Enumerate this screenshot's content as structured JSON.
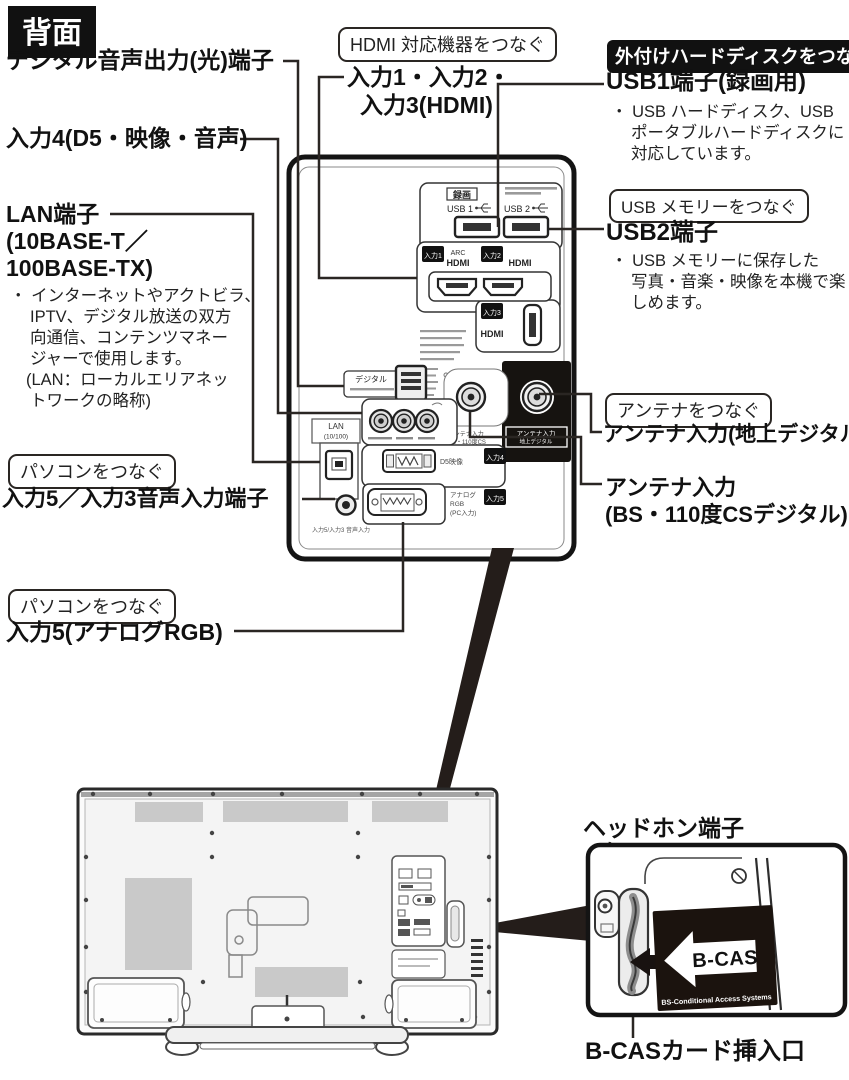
{
  "header": {
    "badge": "背面"
  },
  "left_column": {
    "digital_audio_label": "デジタル音声出力(光)端子",
    "input4_label": "入力4(D5・映像・音声)",
    "lan_label_lines": [
      "LAN端子",
      "(10BASE-T／",
      "100BASE-TX)"
    ],
    "lan_note_lines": [
      "・ インターネットやアクトビラ、",
      "IPTV、デジタル放送の双方",
      "向通信、コンテンツマネー",
      "ジャーで使用します。",
      "(LAN：ローカルエリアネッ",
      "トワークの略称)"
    ],
    "pc_connect_box_1": "パソコンをつなぐ",
    "input5_audio_label": "入力5／入力3音声入力端子",
    "pc_connect_box_2": "パソコンをつなぐ",
    "input5_rgb_label": "入力5(アナログRGB)"
  },
  "top_center": {
    "hdmi_connect_box": "HDMI 対応機器をつなぐ",
    "hdmi_inputs_lines": [
      "入力1・入力2・",
      "入力3(HDMI)"
    ]
  },
  "right_column": {
    "hdd_connect_badge": "外付けハードディスクをつなぐ",
    "usb1_label": "USB1端子(録画用)",
    "usb1_note_lines": [
      "・ USB ハードディスク、USB",
      "ポータブルハードディスクに",
      "対応しています。"
    ],
    "usb_memory_box": "USB メモリーをつなぐ",
    "usb2_label": "USB2端子",
    "usb2_note_lines": [
      "・ USB メモリーに保存した",
      "写真・音楽・映像を本機で楽",
      "しめます。"
    ],
    "antenna_connect_box": "アンテナをつなぐ",
    "antenna_terrestrial_label": "アンテナ入力(地上デジタル)",
    "antenna_bs_lines": [
      "アンテナ入力",
      "(BS・110度CSデジタル)"
    ]
  },
  "rear_panel": {
    "rec_badge": "録画",
    "usb1": "USB 1",
    "usb2": "USB 2",
    "input1_badge": "入力1",
    "input2_badge": "入力2",
    "input3_badge": "入力3",
    "input4_badge": "入力4",
    "input5_badge": "入力5",
    "arc": "ARC",
    "hdmi_logo_1": "HDMI",
    "hdmi_logo_2": "HDMI",
    "hdmi_logo_3": "HDMI",
    "optical_label": "デジタル",
    "lan_lines": [
      "LAN",
      "(10/100)"
    ],
    "d5_label": "D5映像",
    "rgb_lines": [
      "アナログ",
      "RGB",
      "(PC入力)"
    ],
    "antenna_terr_badge_lines": [
      "アンテナ入力",
      "地上デジタル"
    ],
    "antenna_bs_small_lines": [
      "アンテナ入力",
      "BS・110度CS",
      "デジタル"
    ],
    "audio_in_small": "入力5/入力3 音声入力"
  },
  "bottom_section": {
    "headphone_label": "ヘッドホン端子",
    "bcas_slot_label": "B-CASカード挿入口",
    "bcas_card_text": "B-CAS",
    "bcas_card_subtext": "BS-Conditional Access Systems"
  },
  "colors": {
    "ink": "#1a1a1a",
    "line": "#2a2623",
    "badge_bg": "#111111",
    "panel_black": "#161310",
    "vent_gray": "#c9c9c9"
  }
}
